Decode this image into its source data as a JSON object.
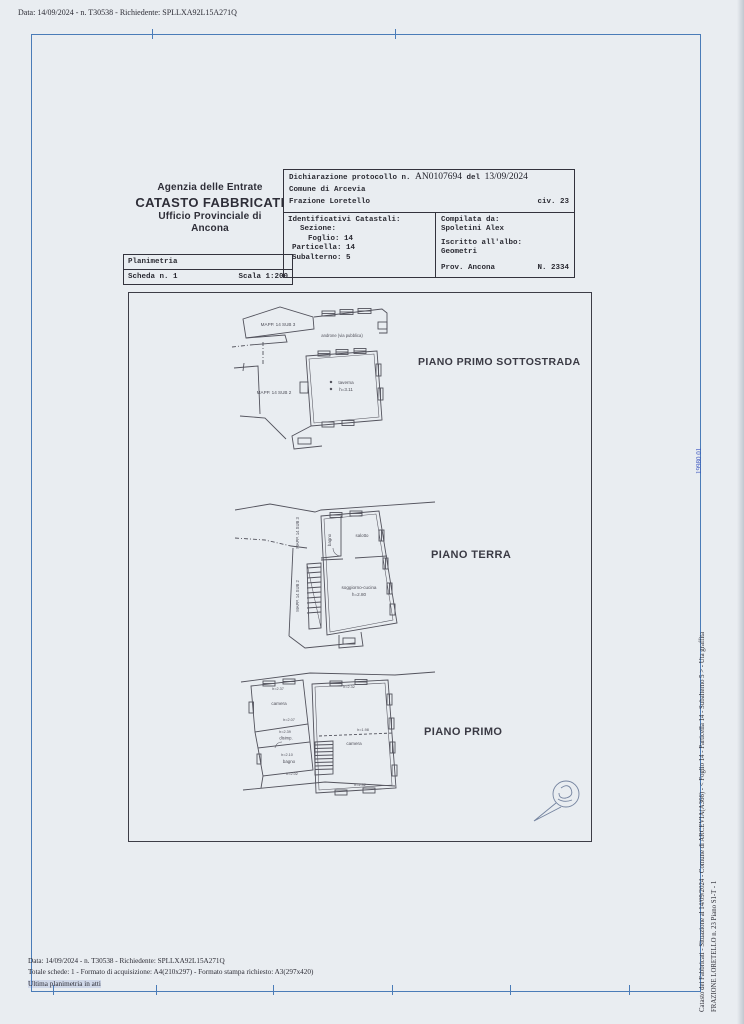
{
  "meta": {
    "top_line": "Data: 14/09/2024 - n. T30538 - Richiedente: SPLLXA92L15A271Q"
  },
  "colors": {
    "paper": "#e9edf1",
    "frame_blue": "#4a7cb8",
    "ink": "#2c2c35",
    "plan_line": "#53535d",
    "stamp_blue": "#74839f",
    "id_blue": "#3b55c0"
  },
  "agency": {
    "line1": "Agenzia delle Entrate",
    "line2": "CATASTO FABBRICATI",
    "line3": "Ufficio Provinciale di",
    "line4": "Ancona"
  },
  "plan_card": {
    "title": "Planimetria",
    "scheda": "Scheda n. 1",
    "scala": "Scala 1:200"
  },
  "decl": {
    "protocol_label": "Dichiarazione protocollo n.",
    "protocol_number": "AN0107694",
    "del_label": "del",
    "protocol_date": "13/09/2024",
    "comune": "Comune di Arcevia",
    "frazione": "Frazione Loretello",
    "civ": "civ. 23",
    "identificativi_title": "Identificativi Catastali:",
    "sezione": "Sezione:",
    "foglio": "Foglio: 14",
    "particella": "Particella: 14",
    "subalterno": "Subalterno: 5",
    "compilata_title": "Compilata da:",
    "compilata_name": "Spoletini Alex",
    "albo_title": "Iscritto all'albo:",
    "albo_value": "Geometri",
    "prov": "Prov. Ancona",
    "albo_number": "N. 2334"
  },
  "plans": {
    "p1": {
      "title": "PIANO PRIMO SOTTOSTRADA",
      "mapp_sub3": "MAPP. 14 SUB 3",
      "mapp_sub2": "MAPP. 14 SUB 2",
      "androne": "androne (via pubblica)",
      "room": "taverna",
      "room_h": "h=3.11"
    },
    "p2": {
      "title": "PIANO TERRA",
      "mapp_sub3": "MAPP. 14 SUB 3",
      "mapp_sub2": "MAPP. 14 SUB 2",
      "bagno": "bagno",
      "salotto": "salotto",
      "room": "soggiorno-cucina",
      "room_h": "h=2.80"
    },
    "p3": {
      "title": "PIANO PRIMO",
      "camera_left": "camera",
      "h_top_left": "h=2.37",
      "h_mid_left": "h=2.07",
      "h_disimp": "h=2.39",
      "disimp": "disimp.",
      "h_bagno": "h=2.10",
      "bagno": "bagno",
      "h_bottom_left": "h=2.02",
      "camera_right": "camera",
      "h_top_right": "h=2.32",
      "h_mid_right": "h=1.98",
      "h_bottom_right": "h=2.32"
    }
  },
  "side": {
    "line1": "Catasto dei Fabbricati - Situazione al 14/09/2024 - Comune di ARCEVIA(A366) - < Foglio 14 - Particella 14 - Subalterno 5 > - Uta graffita",
    "line2": "FRAZIONE LORETELLO n. 23 Piano S1-T - 1",
    "blue_id": "19980 01"
  },
  "footer": {
    "line1": "Data: 14/09/2024 - n. T30538 - Richiedente: SPLLXA92L15A271Q",
    "line2": "Totale schede: 1 - Formato di acquisizione: A4(210x297) - Formato stampa richiesto: A3(297x420)",
    "line3": "Ultima planimetria in atti"
  }
}
